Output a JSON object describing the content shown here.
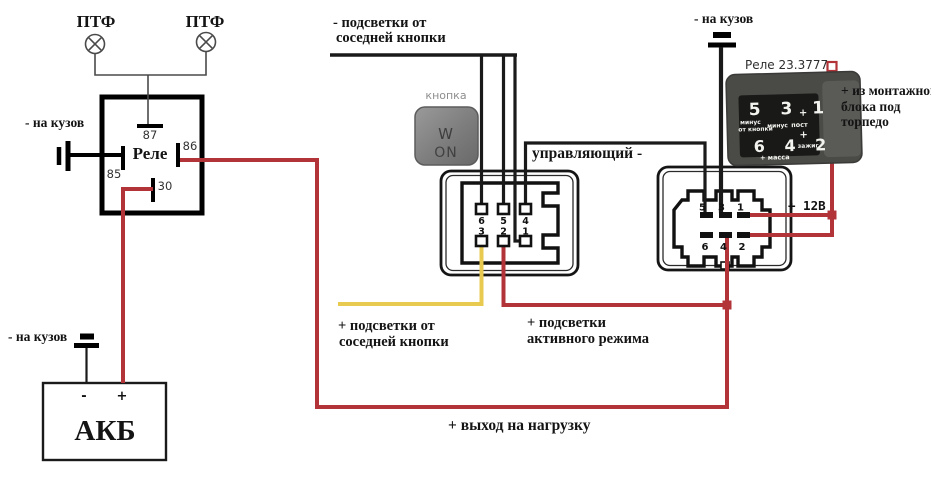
{
  "diagram": {
    "fog_lamp_left": "ПТФ",
    "fog_lamp_right": "ПТФ",
    "ground_relay": "- на кузов",
    "ground_battery": "- на кузов",
    "ground_top_right": "- на кузов",
    "relay": {
      "label": "Реле",
      "pin_87": "87",
      "pin_86": "86",
      "pin_85": "85",
      "pin_30": "30"
    },
    "battery": {
      "label": "АКБ",
      "minus": "-",
      "plus": "+"
    },
    "notes": {
      "minus_backlight_1": "- подсветки от",
      "minus_backlight_2": "соседней кнопки",
      "plus_backlight_1": "+ подсветки от",
      "plus_backlight_2": "соседней кнопки",
      "active_mode_1": "+ подсветки",
      "active_mode_2": "активного режима",
      "output_load": "+ выход на нагрузку",
      "control": "управляющий -",
      "plus_12v": "+ 12В",
      "mounting_1": "+ из монтажного",
      "mounting_2": "блока под",
      "mounting_3": "торпедо"
    },
    "button": {
      "caption": "кнопка",
      "line1": "W",
      "line2": "ON"
    },
    "relay_photo": {
      "caption": "Реле 23.3777",
      "pins_top": "5 3 1",
      "pins_bottom": "6 4 2",
      "plus_top": "+",
      "plus_mid": "+",
      "minus_from_button_1": "минус",
      "minus_from_button_2": "от кнопки",
      "minus_mid": "минус",
      "post": "пост",
      "ignition": "зажиг",
      "mass": "+ масса"
    },
    "connector_mid": {
      "pins_top": [
        "6",
        "5",
        "4"
      ],
      "pins_bottom": [
        "3",
        "2",
        "1"
      ]
    },
    "connector_right": {
      "pins_top": [
        "5",
        "3",
        "1"
      ],
      "pins_bottom": [
        "6",
        "4",
        "2"
      ]
    }
  },
  "colors": {
    "red": "#b23439",
    "yellow": "#e9ca50",
    "black": "#1a1a1a",
    "thin": "#4a4a4a"
  }
}
